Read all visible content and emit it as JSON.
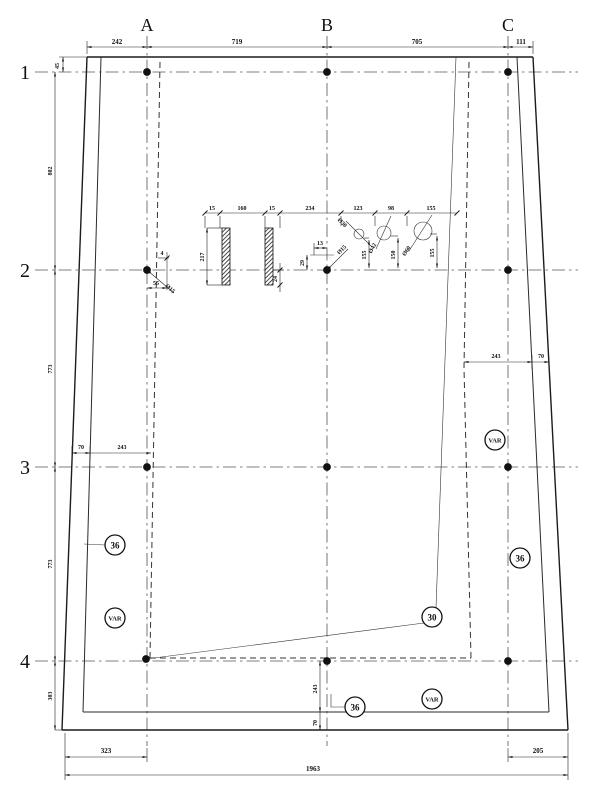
{
  "drawing": {
    "columns": [
      "A",
      "B",
      "C"
    ],
    "rows": [
      "1",
      "2",
      "3",
      "4"
    ],
    "dims": {
      "top": [
        "242",
        "719",
        "705",
        "111"
      ],
      "top_left": "45",
      "left": [
        "802",
        "773",
        "773",
        "303"
      ],
      "left_interior": [
        "70",
        "243"
      ],
      "right_interior": [
        "243",
        "70"
      ],
      "bottom_b": [
        "243",
        "70"
      ],
      "bottom": {
        "left": "323",
        "right": "205",
        "total": "1963"
      }
    },
    "detail": {
      "chain": [
        "15",
        "160",
        "15",
        "234",
        "123",
        "98",
        "155"
      ],
      "bar_height": "217",
      "bar_small": "24",
      "b_node": {
        "h": "13",
        "v": "29",
        "dia": "Ø15"
      },
      "a_node": {
        "w": "55",
        "h": "4",
        "dia": "Ø15"
      },
      "holes": [
        {
          "dia": "Ø30",
          "depth": "155"
        },
        {
          "dia": "Ø42",
          "depth": "150"
        },
        {
          "dia": "Ø60",
          "depth": "155"
        }
      ]
    },
    "markers": {
      "wall_left": "36",
      "var_left": "VAR",
      "var_right": "VAR",
      "wall_right": "36",
      "slope": "30",
      "wall_bottom": "36",
      "var_bottom": "VAR"
    }
  }
}
